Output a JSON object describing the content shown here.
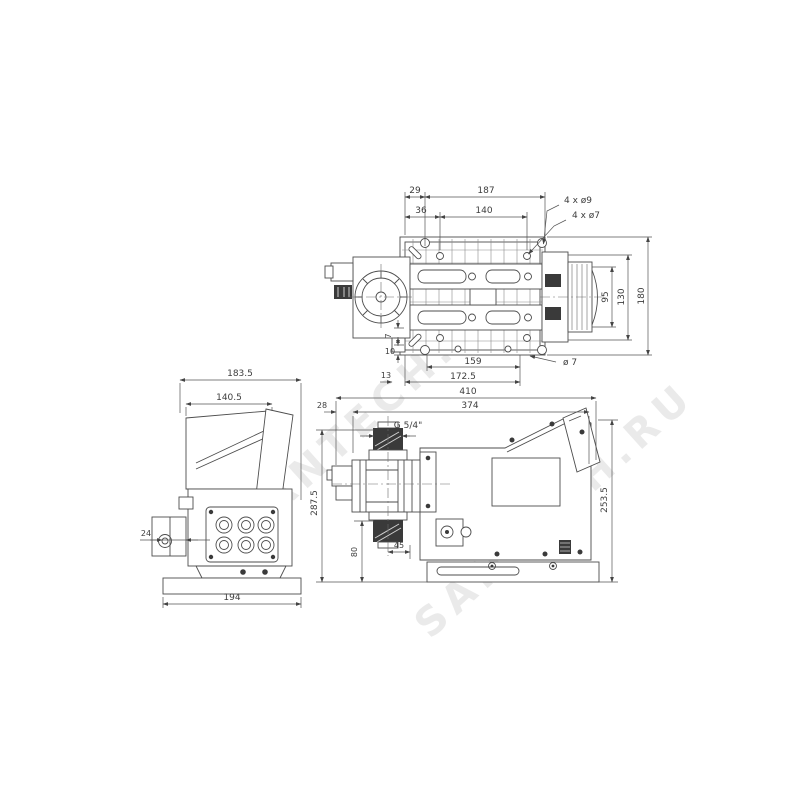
{
  "watermark": {
    "text": "SANTECH.RU"
  },
  "top_view": {
    "dims": {
      "d29": "29",
      "d187": "187",
      "d36": "36",
      "d140": "140",
      "holes9": "4 x ø9",
      "holes7": "4 x ø7",
      "d95": "95",
      "d130": "130",
      "d180": "180",
      "d7": "7",
      "d10": "10",
      "d13": "13",
      "d159": "159",
      "d172_5": "172.5",
      "dia7": "ø 7"
    }
  },
  "front_view": {
    "dims": {
      "d183_5": "183.5",
      "d140_5": "140.5",
      "d24": "24",
      "d194": "194"
    }
  },
  "side_view": {
    "dims": {
      "d410": "410",
      "d374": "374",
      "d28": "28",
      "thread": "G 5/4\"",
      "d287_5": "287.5",
      "d80": "80",
      "d45": "45",
      "d253_5": "253.5"
    }
  }
}
